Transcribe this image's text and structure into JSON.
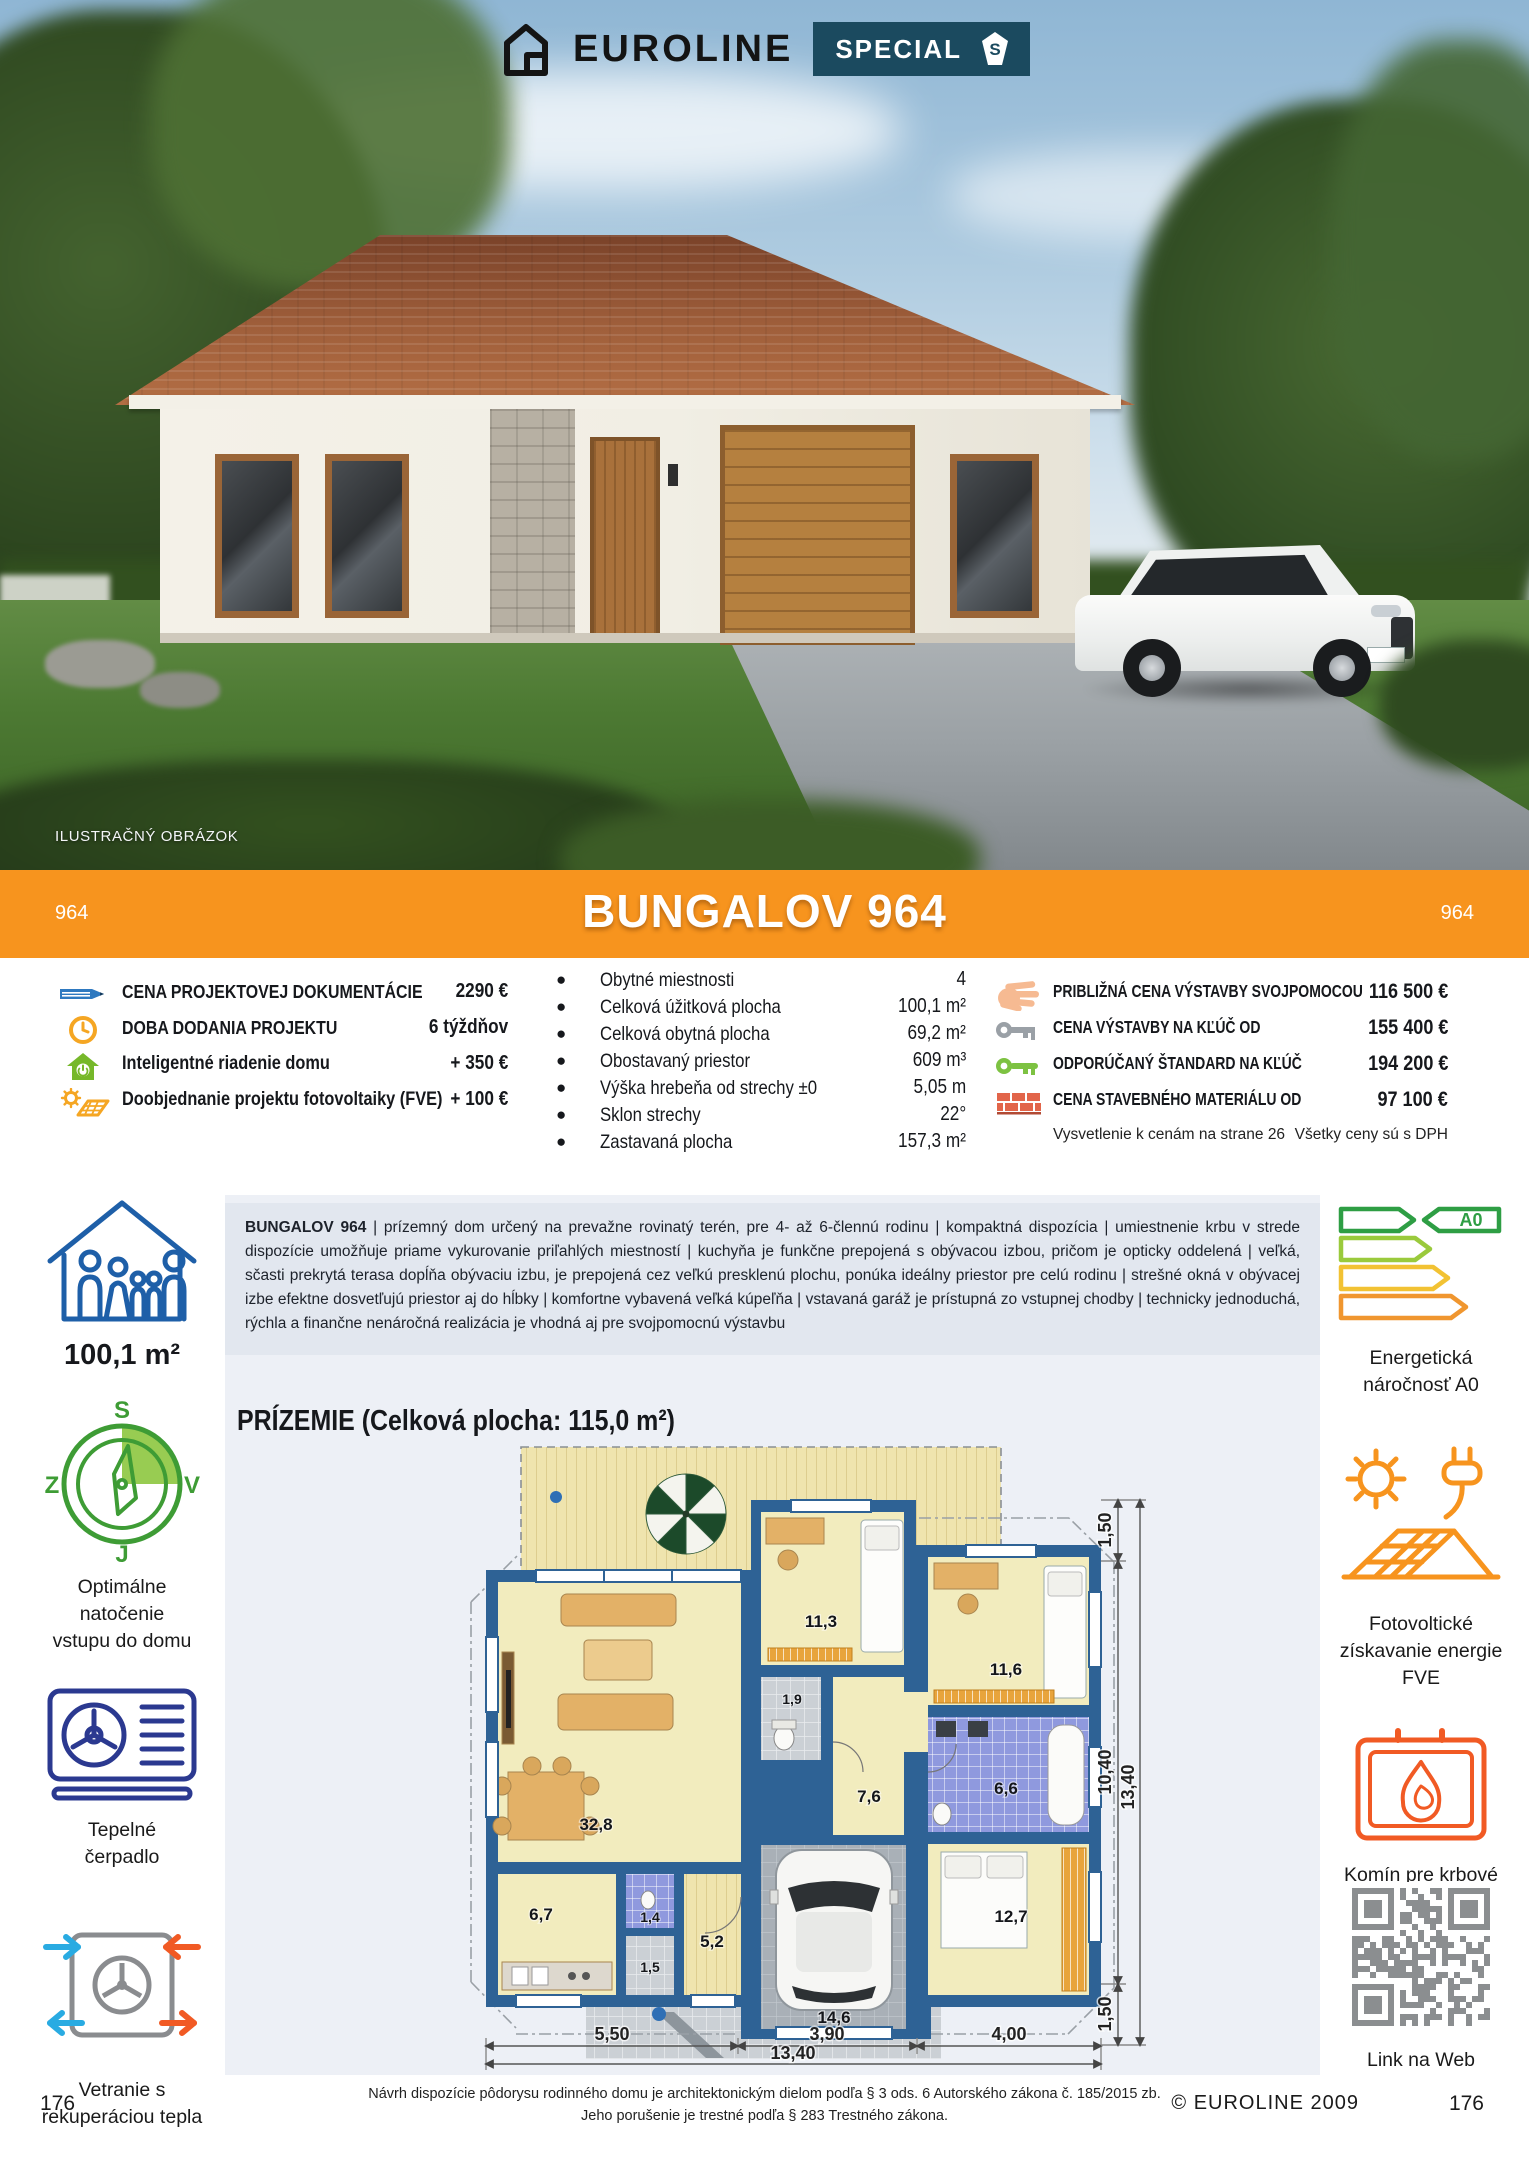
{
  "brand": {
    "name": "EUROLINE",
    "special": "SPECIAL",
    "special_s": "S"
  },
  "photo": {
    "caption": "ILUSTRAČNÝ OBRÁZOK"
  },
  "banner": {
    "code_left": "964",
    "title": "BUNGALOV 964",
    "code_right": "964"
  },
  "project": {
    "rows": [
      {
        "icon": "pencil-icon",
        "label": "CENA PROJEKTOVEJ DOKUMENTÁCIE",
        "value": "2290 €"
      },
      {
        "icon": "clock-icon",
        "label": "DOBA DODANIA PROJEKTU",
        "value": "6 týždňov"
      },
      {
        "icon": "smart-home-icon",
        "label": "Inteligentné riadenie domu",
        "value": "+ 350 €"
      },
      {
        "icon": "solar-addon-icon",
        "label": "Doobjednanie projektu fotovoltaiky (FVE)",
        "value": "+ 100 €"
      }
    ]
  },
  "specs": {
    "rows": [
      {
        "label": "Obytné miestnosti",
        "value": "4"
      },
      {
        "label": "Celková úžitková plocha",
        "value": "100,1 m²"
      },
      {
        "label": "Celková obytná plocha",
        "value": "69,2 m²"
      },
      {
        "label": "Obostavaný priestor",
        "value": "609 m³"
      },
      {
        "label": "Výška hrebeňa od strechy ±0",
        "value": "5,05 m"
      },
      {
        "label": "Sklon strechy",
        "value": "22°"
      },
      {
        "label": "Zastavaná plocha",
        "value": "157,3 m²"
      }
    ]
  },
  "prices": {
    "rows": [
      {
        "icon": "hand-icon",
        "label": "PRIBLIŽNÁ CENA VÝSTAVBY SVOJPOMOCOU",
        "value": "116 500 €"
      },
      {
        "icon": "key-gray-icon",
        "label": "CENA VÝSTAVBY NA KĽÚČ OD",
        "value": "155 400 €"
      },
      {
        "icon": "key-green-icon",
        "label": "ODPORÚČANÝ ŠTANDARD NA KĽÚČ",
        "value": "194 200 €"
      },
      {
        "icon": "bricks-icon",
        "label": "CENA STAVEBNÉHO MATERIÁLU OD",
        "value": "97 100 €"
      }
    ],
    "note_left": "Vysvetlenie k cenám na strane 26",
    "note_right": "Všetky ceny sú s DPH"
  },
  "left_panel": {
    "area": "100,1 m²",
    "compass": {
      "n": "S",
      "e": "V",
      "s": "J",
      "w": "Z"
    },
    "compass_label_1": "Optimálne natočenie",
    "compass_label_2": "vstupu do domu",
    "heat_label_1": "Tepelné",
    "heat_label_2": "čerpadlo",
    "vent_label_1": "Vetranie s",
    "vent_label_2": "rekuperáciou tepla"
  },
  "right_panel": {
    "energy_badge": "A0",
    "energy_label_1": "Energetická",
    "energy_label_2": "náročnosť A0",
    "solar_label_1": "Fotovoltické",
    "solar_label_2": "získavanie energie",
    "solar_label_3": "FVE",
    "fire_label_1": "Komín pre krbové",
    "fire_label_2": "teleso",
    "qr_label": "Link na Web"
  },
  "description": {
    "lead": "BUNGALOV 964",
    "body": " | prízemný dom určený na prevažne rovinatý terén, pre 4- až 6-člennú rodinu |  kompaktná dispozícia | umiestnenie krbu v strede dispozície umožňuje priame vykurovanie priľahlých miestností | kuchyňa je funkčne prepojená s obývacou izbou, pričom je opticky oddelená | veľká, sčasti prekrytá terasa dopĺňa obývaciu izbu, je prepojená cez veľkú presklenú plochu, ponúka ideálny priestor pre celú rodinu | strešné okná v obývacej izbe efektne dosvetľujú priestor aj do hĺbky | komfortne vybavená veľká kúpeľňa | vstavaná garáž je prístupná zo vstupnej chodby | technicky jednoduchá, rýchla a finančne nenáročná realizácia je vhodná aj pre svojpomocnú výstavbu"
  },
  "plan": {
    "title": "PRÍZEMIE (Celková plocha: 115,0 m²)",
    "rooms": {
      "living": "32,8",
      "bedroom1": "11,3",
      "bedroom2": "11,6",
      "wc": "1,9",
      "hall": "7,6",
      "bathroom": "6,6",
      "kitchen": "6,7",
      "wc2": "1,4",
      "hall2": "1,5",
      "entry": "5,2",
      "garage": "14,6",
      "bedroom3": "12,7"
    },
    "dims": {
      "right_top": "1,50",
      "right_mid": "10,40",
      "right_total": "13,40",
      "right_bottom": "1,50",
      "bottom_1": "5,50",
      "bottom_2": "3,90",
      "bottom_3": "4,00",
      "bottom_total": "13,40"
    }
  },
  "footer": {
    "page_left": "176",
    "page_right": "176",
    "copyright": "© EUROLINE 2009",
    "line1": "Návrh dispozície pôdorysu rodinného domu je architektonickým dielom podľa § 3 ods. 6 Autorského zákona č. 185/2015 zb.",
    "line2": "Jeho porušenie je trestné podľa § 283 Trestného zákona."
  }
}
